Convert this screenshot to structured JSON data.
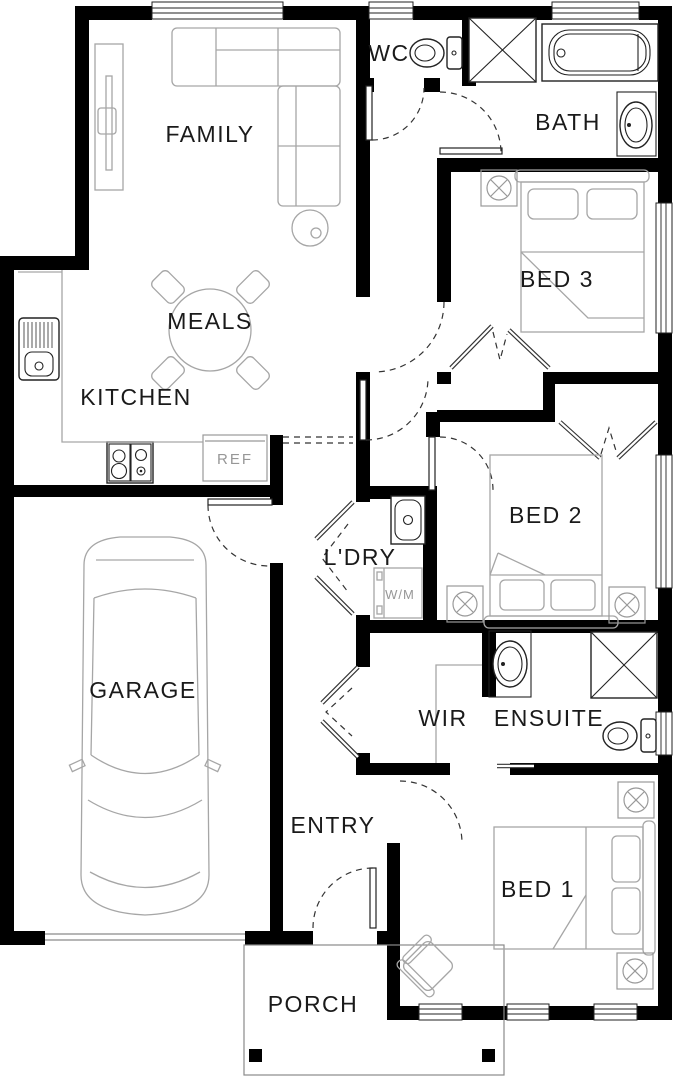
{
  "title": "House floor plan",
  "rooms": {
    "family": "FAMILY",
    "wc": "WC",
    "bath": "BATH",
    "bed3": "BED 3",
    "meals": "MEALS",
    "kitchen": "KITCHEN",
    "ldry": "L'DRY",
    "bed2": "BED 2",
    "garage": "GARAGE",
    "wir": "WIR",
    "ensuite": "ENSUITE",
    "entry": "ENTRY",
    "bed1": "BED 1",
    "porch": "PORCH"
  },
  "fixtures": {
    "fridge": "REF",
    "washing_machine": "W/M"
  },
  "colors": {
    "wall": "#000000",
    "furniture_line": "#a6a6a6",
    "fixture_line": "#222222",
    "label": "#1a1a1a",
    "fixture_label": "#979797",
    "background": "#ffffff"
  }
}
